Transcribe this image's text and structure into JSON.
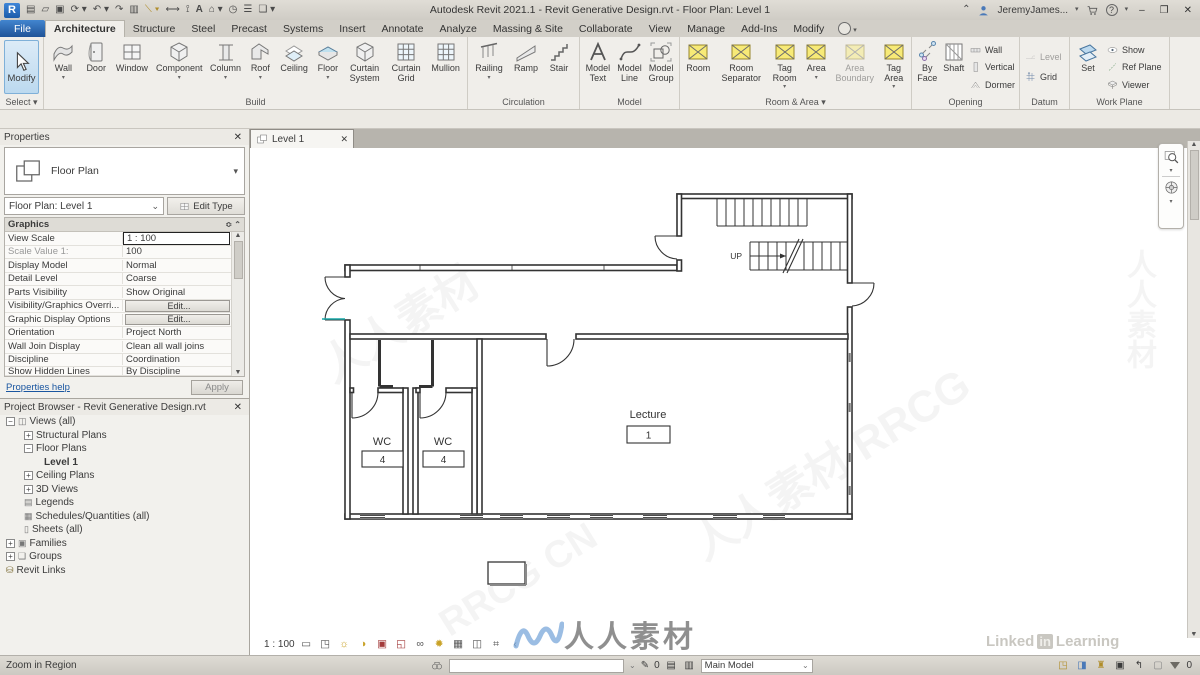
{
  "title_bar": {
    "app_title": "Autodesk Revit 2021.1 - Revit Generative Design.rvt - Floor Plan: Level 1",
    "user_label": "JeremyJames...",
    "qat_icons": [
      "views",
      "open",
      "save",
      "sync",
      "undo",
      "redo",
      "print",
      "measure",
      "aligned-dimension",
      "tag",
      "text",
      "default-3d-view",
      "section",
      "thin-lines",
      "switch-windows"
    ],
    "right_icons": [
      "search",
      "user",
      "cart",
      "help"
    ]
  },
  "tab_bar": {
    "file_tab": "File",
    "tabs": [
      "Architecture",
      "Structure",
      "Steel",
      "Precast",
      "Systems",
      "Insert",
      "Annotate",
      "Analyze",
      "Massing & Site",
      "Collaborate",
      "View",
      "Manage",
      "Add-Ins",
      "Modify"
    ],
    "active_tab": "Architecture"
  },
  "ribbon": {
    "select": {
      "modify_label": "Modify",
      "group_label": "Select"
    },
    "build": {
      "items": [
        "Wall",
        "Door",
        "Window",
        "Component",
        "Column",
        "Roof",
        "Ceiling",
        "Floor",
        "Curtain System",
        "Curtain Grid",
        "Mullion"
      ],
      "group_label": "Build"
    },
    "circulation": {
      "items": [
        "Railing",
        "Ramp",
        "Stair"
      ],
      "group_label": "Circulation"
    },
    "model": {
      "items": [
        "Model Text",
        "Model Line",
        "Model Group"
      ],
      "group_label": "Model"
    },
    "room_area": {
      "items": [
        "Room",
        "Room Separator",
        "Tag Room",
        "Area",
        "Area Boundary",
        "Tag Area"
      ],
      "group_label": "Room & Area"
    },
    "opening": {
      "items": [
        "By Face",
        "Shaft",
        "Wall",
        "Vertical",
        "Dormer"
      ],
      "group_label": "Opening"
    },
    "datum": {
      "items": [
        "Level",
        "Grid"
      ],
      "group_label": "Datum"
    },
    "work_plane": {
      "items": [
        "Set",
        "Show",
        "Ref Plane",
        "Viewer"
      ],
      "group_label": "Work Plane"
    }
  },
  "properties": {
    "panel_title": "Properties",
    "type_selector": "Floor Plan",
    "instance_selector": "Floor Plan: Level 1",
    "edit_type_label": "Edit Type",
    "section_header": "Graphics",
    "rows": [
      {
        "label": "View Scale",
        "value": "1 : 100"
      },
      {
        "label": "Scale Value    1:",
        "value": "100"
      },
      {
        "label": "Display Model",
        "value": "Normal"
      },
      {
        "label": "Detail Level",
        "value": "Coarse"
      },
      {
        "label": "Parts Visibility",
        "value": "Show Original"
      },
      {
        "label": "Visibility/Graphics Overri...",
        "value": "Edit..."
      },
      {
        "label": "Graphic Display Options",
        "value": "Edit..."
      },
      {
        "label": "Orientation",
        "value": "Project North"
      },
      {
        "label": "Wall Join Display",
        "value": "Clean all wall joins"
      },
      {
        "label": "Discipline",
        "value": "Coordination"
      },
      {
        "label": "Show Hidden Lines",
        "value": "By Discipline"
      }
    ],
    "help_link": "Properties help",
    "apply_label": "Apply"
  },
  "project_browser": {
    "panel_title": "Project Browser - Revit Generative Design.rvt",
    "items": [
      "Views (all)",
      "Structural Plans",
      "Floor Plans",
      "Level 1",
      "Ceiling Plans",
      "3D Views",
      "Legends",
      "Schedules/Quantities (all)",
      "Sheets (all)",
      "Families",
      "Groups",
      "Revit Links"
    ]
  },
  "drawing_area": {
    "view_tab": "Level 1",
    "plan": {
      "rooms": [
        {
          "name": "WC",
          "number": "4"
        },
        {
          "name": "WC",
          "number": "4"
        },
        {
          "name": "Lecture",
          "number": "1"
        }
      ],
      "stair_label": "UP"
    }
  },
  "view_control_bar": {
    "scale": "1 : 100",
    "icons": [
      "detail-level",
      "visual-style",
      "sun-path",
      "shadows",
      "crop-view",
      "show-crop",
      "temporary-hide-isolate",
      "reveal-hidden",
      "temporary-view-properties",
      "show-analytical",
      "reveal-constraints"
    ]
  },
  "status_bar": {
    "hint": "Zoom in Region",
    "selection_count": "0",
    "design_option": "Main Model",
    "filter_count": "0"
  },
  "watermarks": {
    "code": "RRCG CN",
    "cn_logo": "人人素材",
    "diagonal_1": "人人素材",
    "diagonal_2": "人人素材 RRCG",
    "linkedin": {
      "part1": "Linked",
      "part2": "in",
      "part3": "Learning"
    }
  }
}
